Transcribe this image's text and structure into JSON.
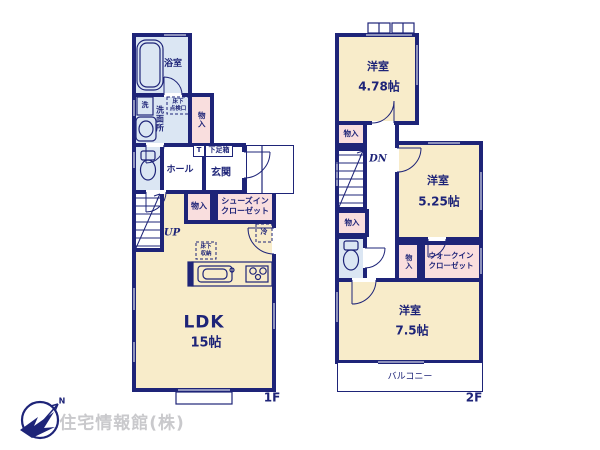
{
  "colors": {
    "wall": "#1e2478",
    "room_cream": "#f8ecca",
    "wet_blue": "#dbe6f3",
    "closet_pink": "#f9dede"
  },
  "floor1": {
    "floor_label": "1F",
    "bathroom": "浴室",
    "washer": "洗",
    "washroom": "洗面所",
    "hatch_line1": "床下",
    "hatch_line2": "点検口",
    "storage_a": "物入",
    "shoebox_t": "T",
    "shoebox": "下足箱",
    "hall": "ホール",
    "entrance": "玄関",
    "storage_b": "物入",
    "shoes_closet_line1": "シューズイン",
    "shoes_closet_line2": "クローゼット",
    "stairs": "UP",
    "fridge": "冷",
    "floor_storage_line1": "床下",
    "floor_storage_line2": "収納",
    "ldk": "LDK",
    "ldk_size": "15帖"
  },
  "floor2": {
    "floor_label": "2F",
    "room1": "洋室",
    "room1_size": "4.78帖",
    "storage_a": "物入",
    "stairs": "DN",
    "storage_b": "物入",
    "storage_c": "物入",
    "room2": "洋室",
    "room2_size": "5.25帖",
    "wic_line1": "ウォークイン",
    "wic_line2": "クローゼット",
    "room3": "洋室",
    "room3_size": "7.5帖",
    "balcony": "バルコニー"
  },
  "logo": {
    "company": "住宅情報館(株)",
    "north": "N"
  }
}
